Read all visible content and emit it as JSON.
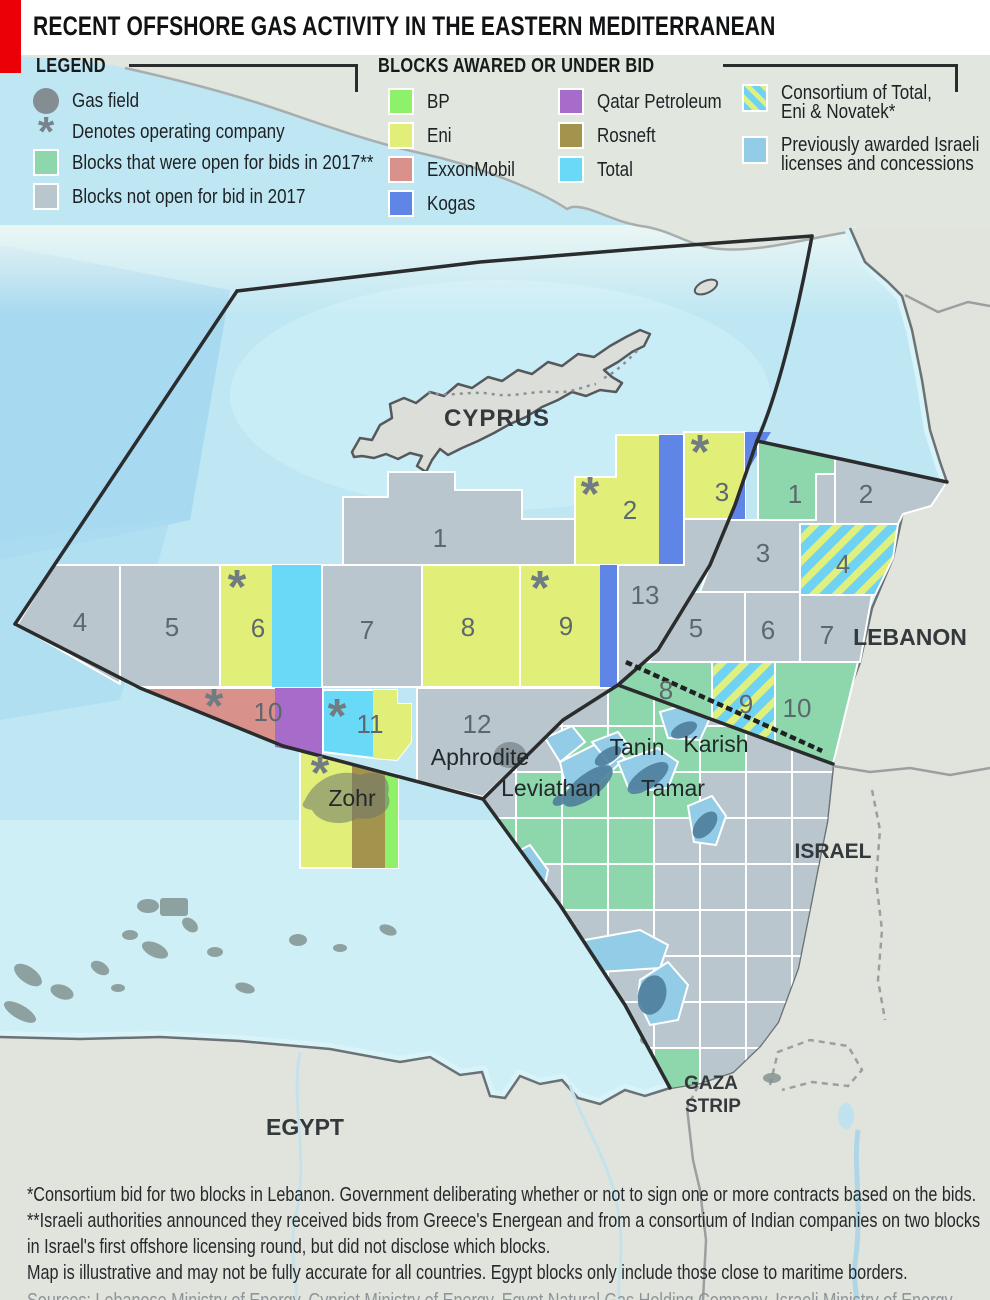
{
  "header": {
    "title": "RECENT OFFSHORE GAS ACTIVITY IN THE EASTERN MEDITERRANEAN"
  },
  "legend": {
    "title": "LEGEND",
    "gas_field_label": "Gas field",
    "operator_label": "Denotes operating company",
    "open_label": "Blocks that were open for bids in 2017**",
    "closed_label": "Blocks not open for bid in 2017",
    "open_color": "#8ed6ab",
    "closed_color": "#b9c6cd"
  },
  "companies": {
    "title": "BLOCKS AWARED OR UNDER BID",
    "items": [
      {
        "name": "BP",
        "color": "#8ff069"
      },
      {
        "name": "Eni",
        "color": "#e1ef79"
      },
      {
        "name": "ExxonMobil",
        "color": "#d9928b"
      },
      {
        "name": "Kogas",
        "color": "#5f85e7"
      },
      {
        "name": "Qatar Petroleum",
        "color": "#a76cc9"
      },
      {
        "name": "Rosneft",
        "color": "#a3944d"
      },
      {
        "name": "Total",
        "color": "#68d9f7"
      }
    ],
    "consortium_line1": "Consortium of Total,",
    "consortium_line2": "Eni & Novatek*",
    "israeli_line1": "Previously awarded Israeli",
    "israeli_line2": "licenses and concessions",
    "israeli_color": "#93cce6"
  },
  "map": {
    "operator_mark": "*",
    "countries": {
      "cyprus": "CYPRUS",
      "lebanon": "LEBANON",
      "israel": "ISRAEL",
      "egypt": "EGYPT",
      "gaza1": "GAZA",
      "gaza2": "STRIP"
    },
    "fields": {
      "aphrodite": "Aphrodite",
      "zohr": "Zohr",
      "leviathan": "Leviathan",
      "tamar": "Tamar",
      "tanin": "Tanin",
      "karish": "Karish"
    },
    "cyprus_blocks": {
      "b1": "1",
      "b2": "2",
      "b3": "3",
      "b4": "4",
      "b5": "5",
      "b6": "6",
      "b7": "7",
      "b8": "8",
      "b9": "9",
      "b10": "10",
      "b11": "11",
      "b12": "12",
      "b13": "13"
    },
    "lebanon_blocks": {
      "b1": "1",
      "b2": "2",
      "b3": "3",
      "b4": "4",
      "b5": "5",
      "b6": "6",
      "b7": "7",
      "b8": "8",
      "b9": "9",
      "b10": "10"
    }
  },
  "footnotes": {
    "fn1": "*Consortium bid for two blocks in Lebanon. Government deliberating whether or not to sign one or more contracts based on the bids.",
    "fn2": "**Israeli authorities announced they received bids from Greece's Energean and from a consortium of Indian companies on two blocks in Israel's first offshore licensing round, but did not disclose which blocks.",
    "fn3": "Map is illustrative and may not be fully accurate for all countries. Egypt blocks only include those close to maritime borders.",
    "sources": "Sources: Lebanese Ministry of Energy, Cypriot Ministry of Energy, Egypt Natural Gas Holding Company, Israeli Ministry of Energy"
  }
}
